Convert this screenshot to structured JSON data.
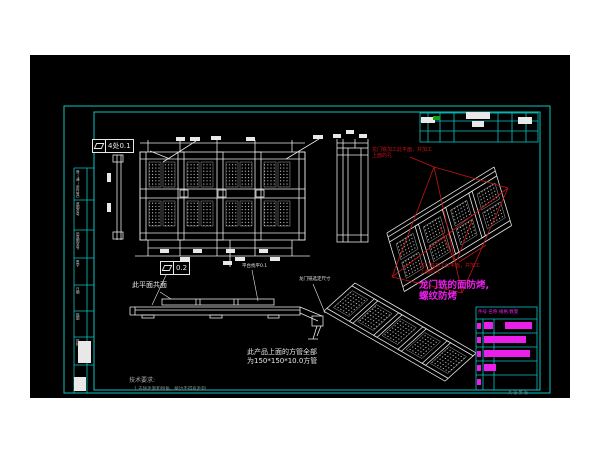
{
  "window": {
    "page_bg": "#ffffff",
    "canvas_bg": "#000000"
  },
  "colors": {
    "frame_cyan": "#0cc4c4",
    "linework_white": "#e8e8e8",
    "annotation_red": "#c41414",
    "note_magenta": "#ea1fea",
    "revision_green": "#16a016",
    "dim_gray": "#a8a8a8"
  },
  "tolerances": {
    "top": {
      "symbol": "flatness",
      "value": "4处0.1"
    },
    "mid": {
      "symbol": "flatness",
      "value": "0.2"
    }
  },
  "labels": {
    "coplanar": "此平面共面",
    "platform_leveling": "平台找平0.1",
    "gantry_fixed_dim": "龙门铣选定尺寸"
  },
  "notes": {
    "red_top_1": "龙门铣加工此平面，并加工",
    "red_top_2": "上面的孔",
    "red_bottom_1": "龙门铣加工此平面，并加工",
    "red_bottom_2": "上面的孔",
    "magenta_1": "龙门铣的面防烤,",
    "magenta_2": "螺纹防烤",
    "tube_1": "此产品上面的方管全部",
    "tube_2": "为150*150*10.0方管",
    "tech_title": "技术要求:",
    "tech_1": "1.去除毛刺和锐角，棱边不得有毛刺"
  },
  "parts_table": {
    "header": "件号 名称 规格 数量"
  },
  "margin_strip": {
    "rows": [
      "借(通)用件登记",
      "底图总号",
      "旧底图总号",
      "签字",
      "日期",
      "描图",
      "描校"
    ]
  },
  "stamp": "共 张 第 张"
}
